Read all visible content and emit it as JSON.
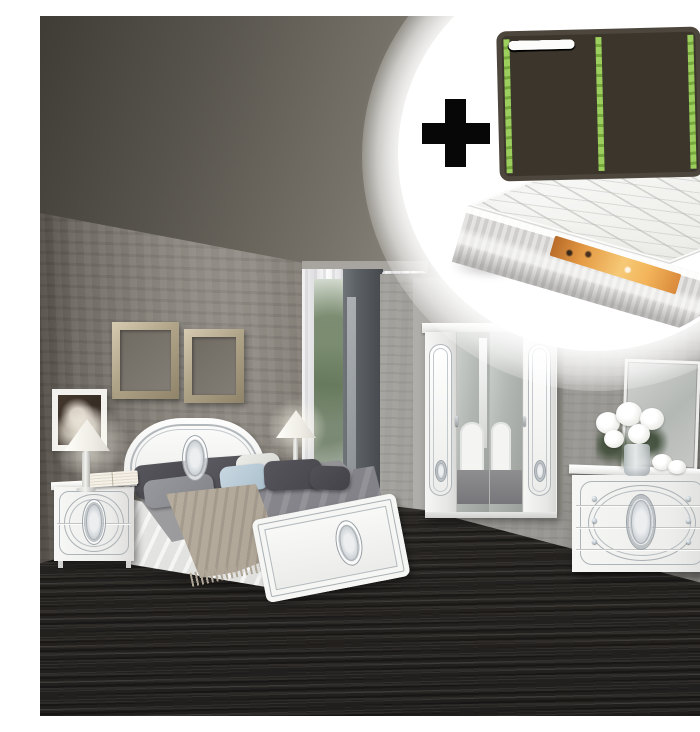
{
  "image": {
    "kind": "product photo",
    "subject": "White gloss bedroom set with silver ornament: bed, nightstand, lamps, 4-door mirrored wardrobe, dresser with mirror, shown in a grey bedroom",
    "inset": {
      "plus_sign": "+",
      "items": [
        "slatted bed base",
        "mattress"
      ],
      "slat_base": {
        "rows": 7,
        "columns": 2
      }
    },
    "furniture": [
      "double bed with ornament medallions",
      "two-drawer nightstand",
      "table lamps with white shades",
      "four-door wardrobe with two mirror doors",
      "three-drawer dresser with crystal knobs",
      "leaning wall mirror",
      "white flower bouquet",
      "empty champagne wall frames",
      "black-and-white wall photo"
    ],
    "colors": {
      "furniture_white": "#f4f4f2",
      "silver_trim": "#a9afb3",
      "wall_grey": "#7b766f",
      "ceiling_grey": "#8a8780",
      "floor_charcoal": "#2b2826",
      "slat_rail_green": "#8fbf4e",
      "slat_frame_dark": "#3e382f",
      "mattress_label_orange": "#e59a44",
      "bedding_grey": "#8c8c8e",
      "throw_beige": "#b3a99b",
      "pillow_blue": "#bccfdb"
    }
  }
}
